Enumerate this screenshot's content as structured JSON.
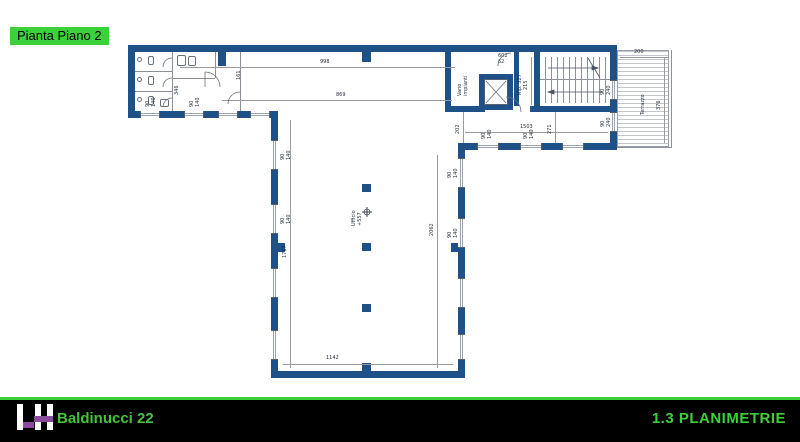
{
  "title_chip": {
    "label": "Pianta Piano 2"
  },
  "plan": {
    "labels": {
      "office": "Ufficio\n+557",
      "utility": "Vano\nimpianti",
      "storage": "Rip. 327",
      "terrace": "Terrazzo"
    },
    "dims": {
      "top_interior": "998",
      "south_interior": "869",
      "right_wing_width": "1503",
      "hall_left_height": "1717",
      "hall_right_height": "2062",
      "hall_bottom_width": "1142",
      "lobby_height": "271",
      "lobby_left": "202",
      "stair_width": "215",
      "terrace_top": "200",
      "terrace_side": "376",
      "door_tag": "602\n62",
      "aux_a": "346",
      "aux_b": "161"
    },
    "window_tag": "90\n140",
    "terrace_door_tag": "90\n240",
    "colors": {
      "wall_blue": "#1d5187",
      "dimension_gray": "#9a9a9a"
    }
  },
  "footer": {
    "logo": {
      "letters": "LH",
      "purple": "#8c4a9c",
      "white": "#ffffff"
    },
    "project": "Baldinucci 22",
    "section": "1.3 PLANIMETRIE",
    "accent_green": "#3bd139",
    "background": "#000000"
  }
}
